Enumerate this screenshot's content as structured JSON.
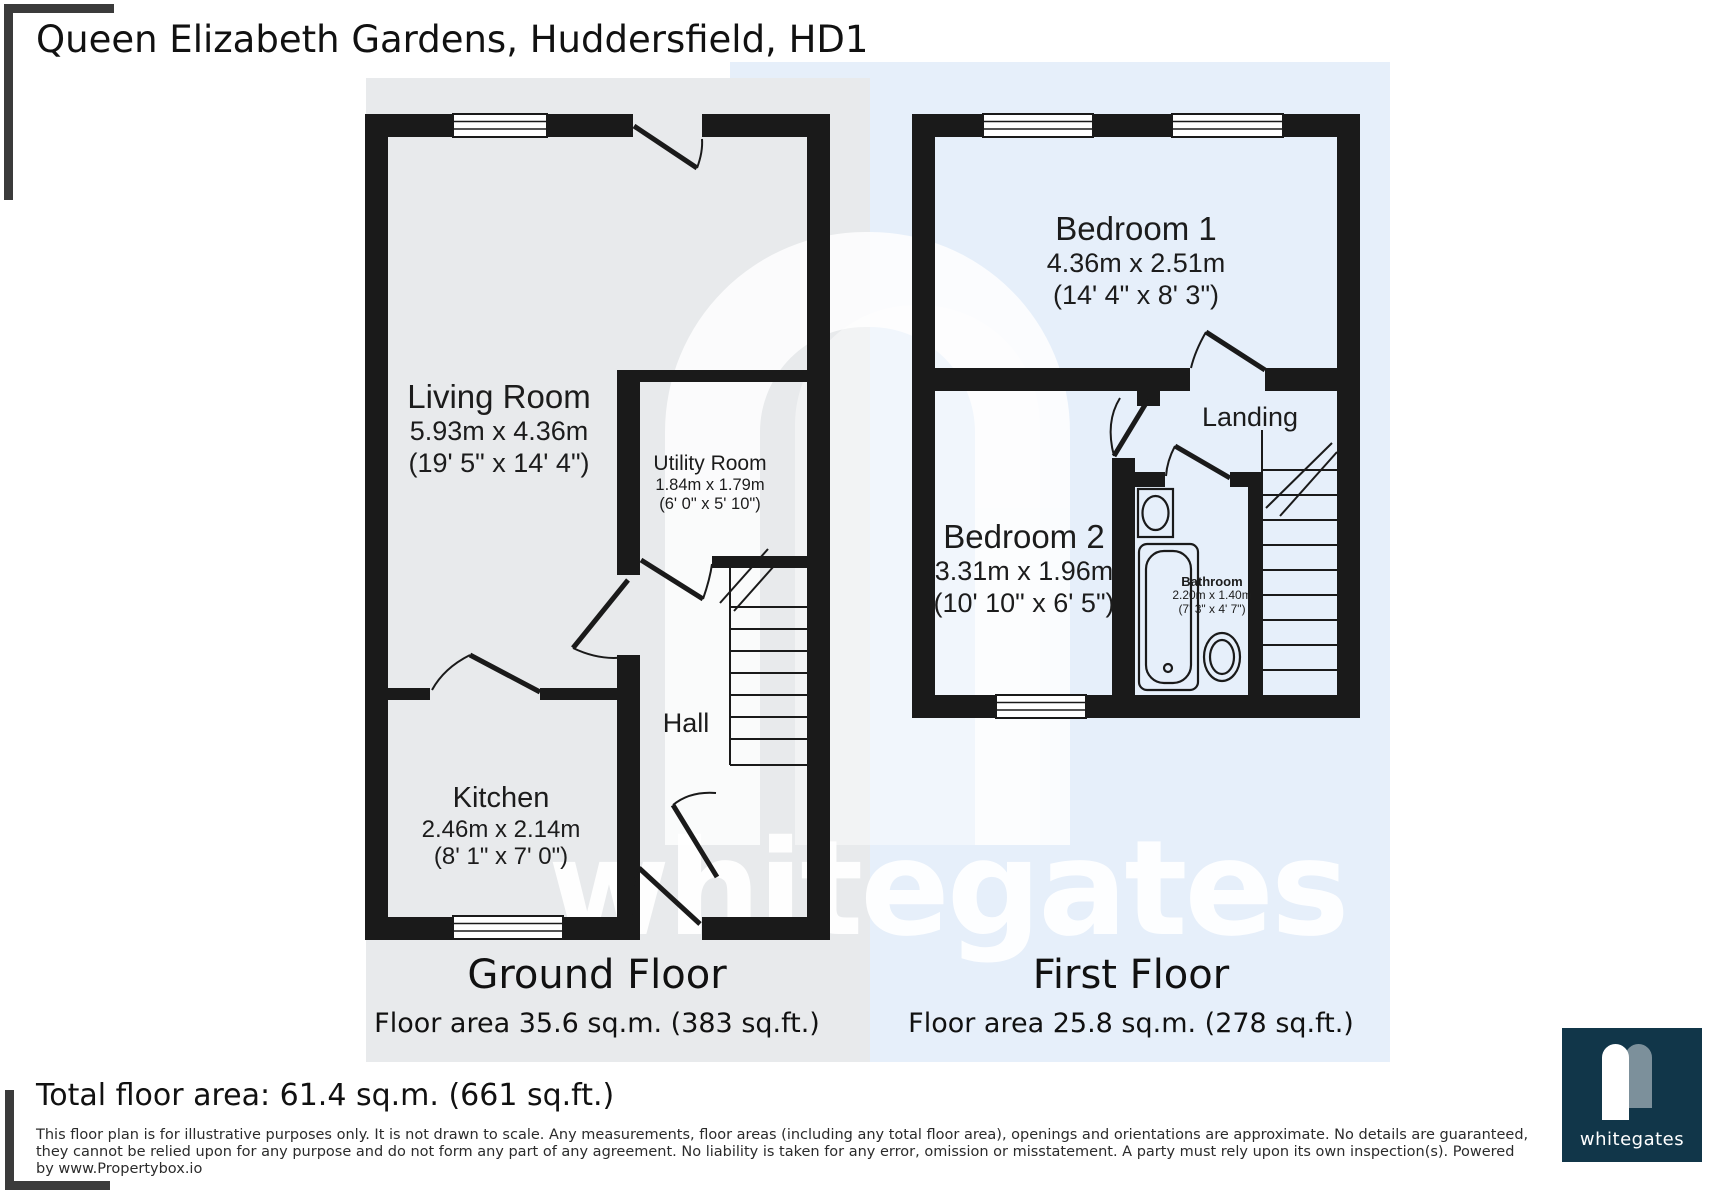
{
  "title": "Queen Elizabeth Gardens, Huddersfield, HD1",
  "ground_floor": {
    "caption": "Ground Floor",
    "area_label": "Floor area 35.6 sq.m. (383 sq.ft.)",
    "rooms": {
      "living": {
        "name": "Living Room",
        "dims_m": "5.93m x 4.36m",
        "dims_ft": "(19' 5\" x 14' 4\")"
      },
      "utility": {
        "name": "Utility Room",
        "dims_m": "1.84m x 1.79m",
        "dims_ft": "(6' 0\" x 5' 10\")"
      },
      "kitchen": {
        "name": "Kitchen",
        "dims_m": "2.46m x 2.14m",
        "dims_ft": "(8' 1\" x 7' 0\")"
      },
      "hall": {
        "name": "Hall"
      }
    }
  },
  "first_floor": {
    "caption": "First Floor",
    "area_label": "Floor area 25.8 sq.m. (278 sq.ft.)",
    "rooms": {
      "bedroom1": {
        "name": "Bedroom 1",
        "dims_m": "4.36m x 2.51m",
        "dims_ft": "(14' 4\" x 8' 3\")"
      },
      "bedroom2": {
        "name": "Bedroom 2",
        "dims_m": "3.31m x 1.96m",
        "dims_ft": "(10' 10\" x 6' 5\")"
      },
      "bathroom": {
        "name": "Bathroom",
        "dims_m": "2.20m x 1.40m",
        "dims_ft": "(7' 3\" x 4' 7\")"
      },
      "landing": {
        "name": "Landing"
      }
    }
  },
  "total_area": "Total floor area: 61.4 sq.m. (661 sq.ft.)",
  "disclaimer": [
    "This floor plan is for illustrative purposes only. It is not drawn to scale. Any measurements, floor areas (including any total floor area), openings and orientations are approximate. No details are guaranteed,",
    "they cannot be relied upon for any purpose and do not form any part of any agreement. No liability is taken for any error, omission or misstatement. A party must rely upon its own inspection(s). Powered",
    "by www.Propertybox.io"
  ],
  "watermark_text": "whitegates",
  "logo": {
    "text": "whitegates",
    "box_color": "#113649"
  },
  "colors": {
    "wall": "#1a1a1a",
    "ground_panel": "#e8eaec",
    "first_panel": "#e6effa",
    "bracket": "#3b3b3b"
  }
}
